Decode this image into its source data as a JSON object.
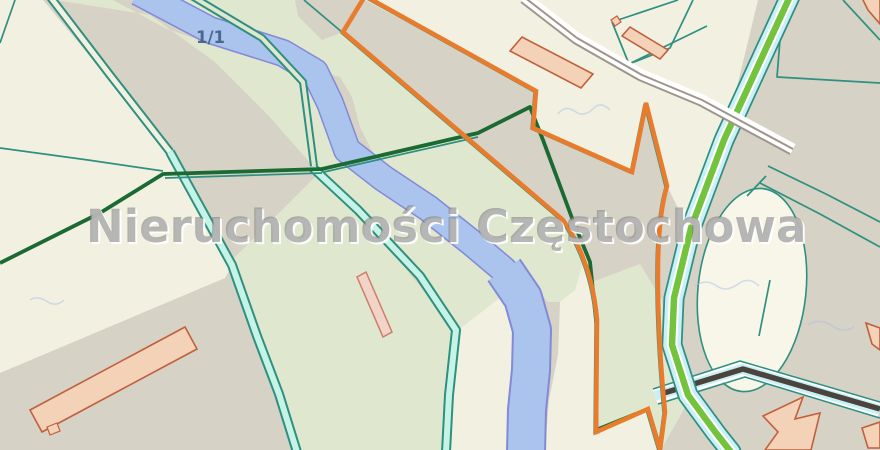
{
  "watermark": {
    "text": "Nieruchomości Częstochowa"
  },
  "map": {
    "parcel_label": "1/1",
    "colors": {
      "background": "#d6d2c5",
      "cream": "#f2f1e1",
      "pale_green": "#dfe8cf",
      "ivory": "#f7f6e9",
      "aqua": "#c5f3e6",
      "river_fill": "#aac4ee",
      "river_edge": "#8389d6",
      "boundary_teal": "#2f8f80",
      "utility_dark_green": "#1a6a32",
      "selected_parcel_orange": "#e87c2c",
      "road_green": "#74c33d",
      "road_casing_cyan": "#c9f0f6",
      "path_gray": "#9e968c",
      "road_dark": "#4a443c",
      "building_fill": "#f3d2b8",
      "building_stroke": "#c1603c",
      "label_blue": "#3d5c80"
    }
  }
}
